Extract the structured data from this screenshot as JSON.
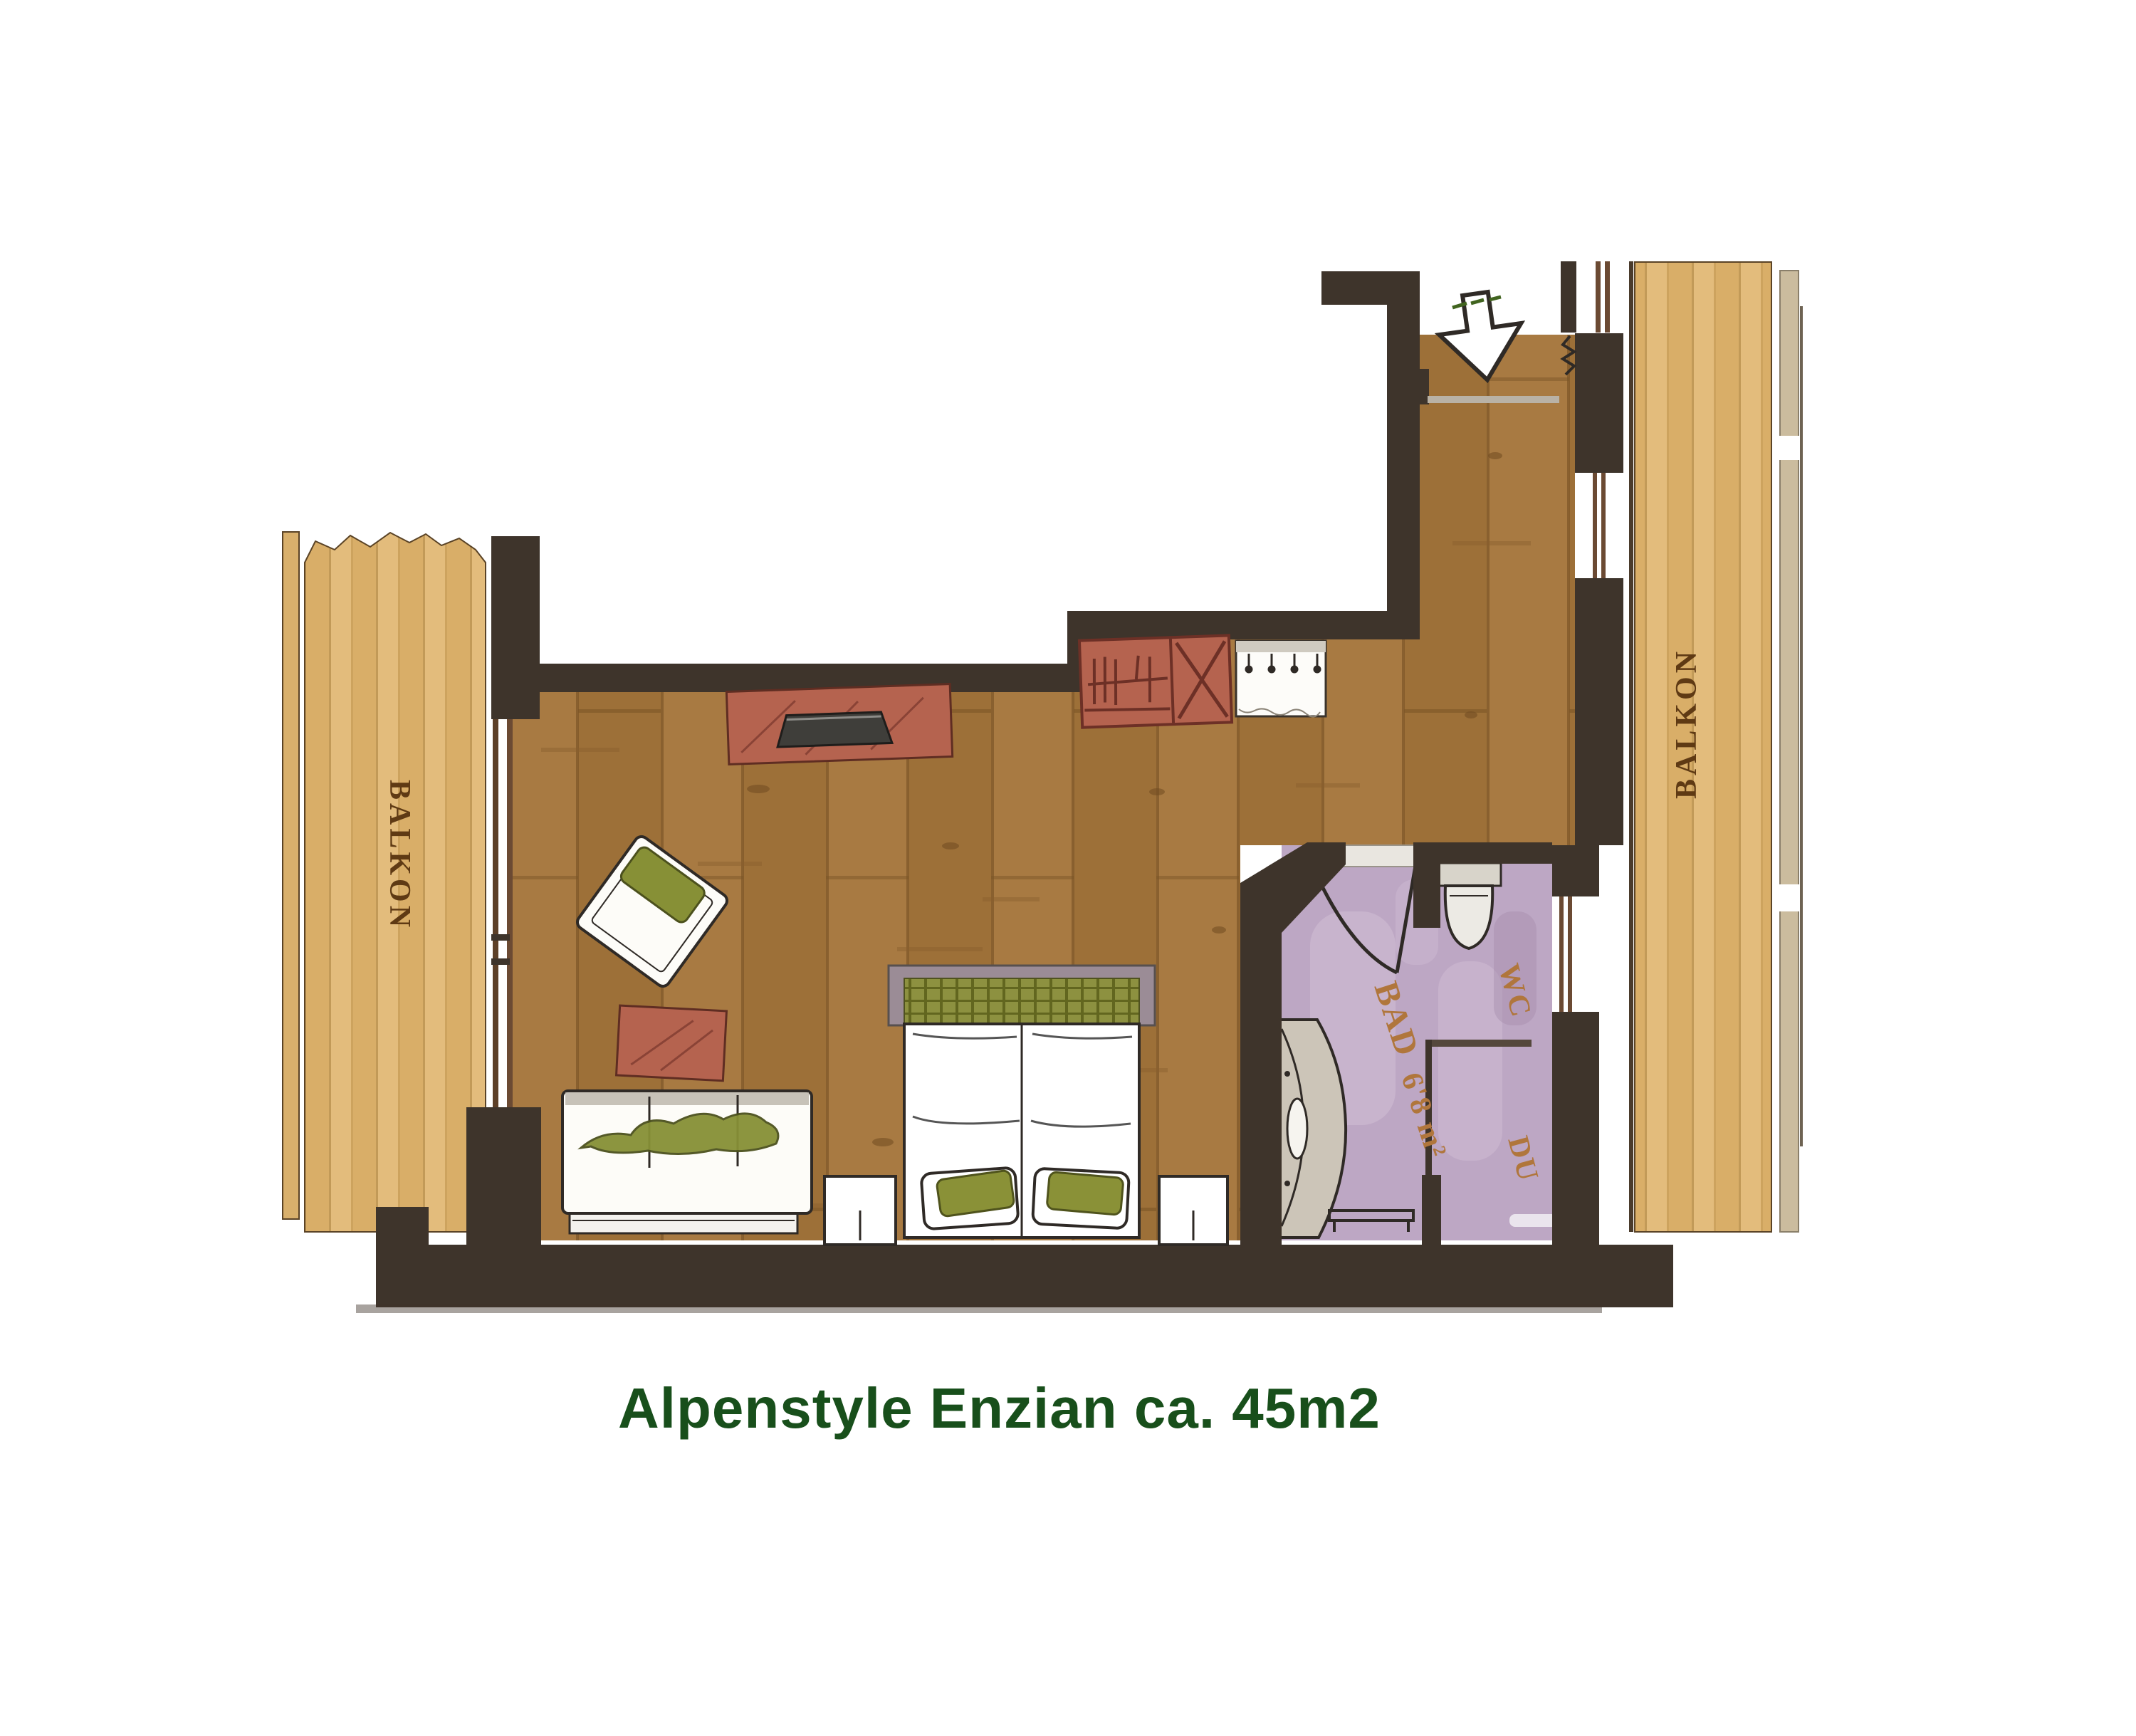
{
  "title": {
    "text": "Alpenstyle Enzian ca. 45m2",
    "color": "#184f1b"
  },
  "labels": {
    "balcony_left": "BALKON",
    "balcony_right": "BALKON",
    "bathroom": "BAD",
    "bathroom_area": "6'8 m²",
    "toilet": "WC",
    "shower": "DU"
  },
  "icons": {
    "entrance_arrow": "down-arrow"
  },
  "colors": {
    "wall": "#3e342b",
    "floor_wood": "#a87a42",
    "balcony_wood": "#e3bc7c",
    "bathroom_floor": "#bda7c4",
    "furniture_accent": "#b5634f",
    "upholstery_green": "#879036",
    "balcony_label": "#5f3a14",
    "bathroom_label": "#b0763c",
    "title_green": "#184f1b"
  }
}
